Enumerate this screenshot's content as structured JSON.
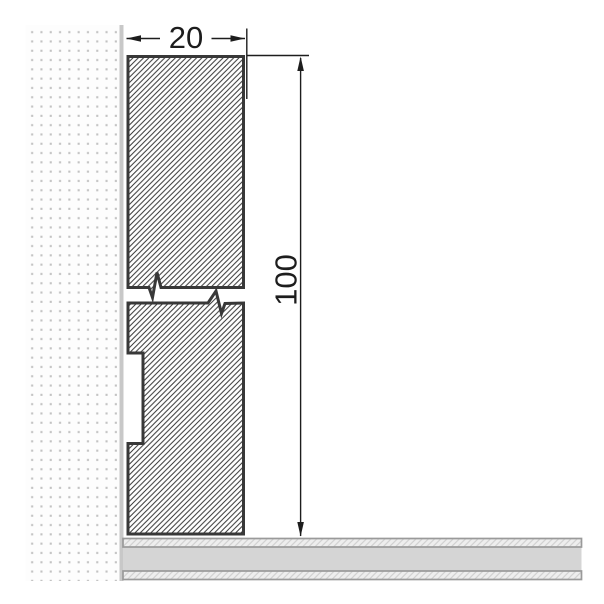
{
  "drawing": {
    "kind": "cross-section-dimension-drawing",
    "dimensions": {
      "width": {
        "label": "20",
        "value": 20
      },
      "height": {
        "label": "100",
        "value": 100
      }
    },
    "palette": {
      "background": "#ffffff",
      "outline": "#383838",
      "hatch_line": "#333333",
      "dimension_color": "#1d1d1d",
      "wall_dot": "#c2c2c2",
      "wall_edge": "#c8c8c8",
      "floor_mid_gray": "#d5d5d5",
      "floor_hatch_bg": "#eeeeee",
      "floor_hatch_line": "#cfcfcf",
      "floor_border": "#9a9a9a"
    }
  }
}
